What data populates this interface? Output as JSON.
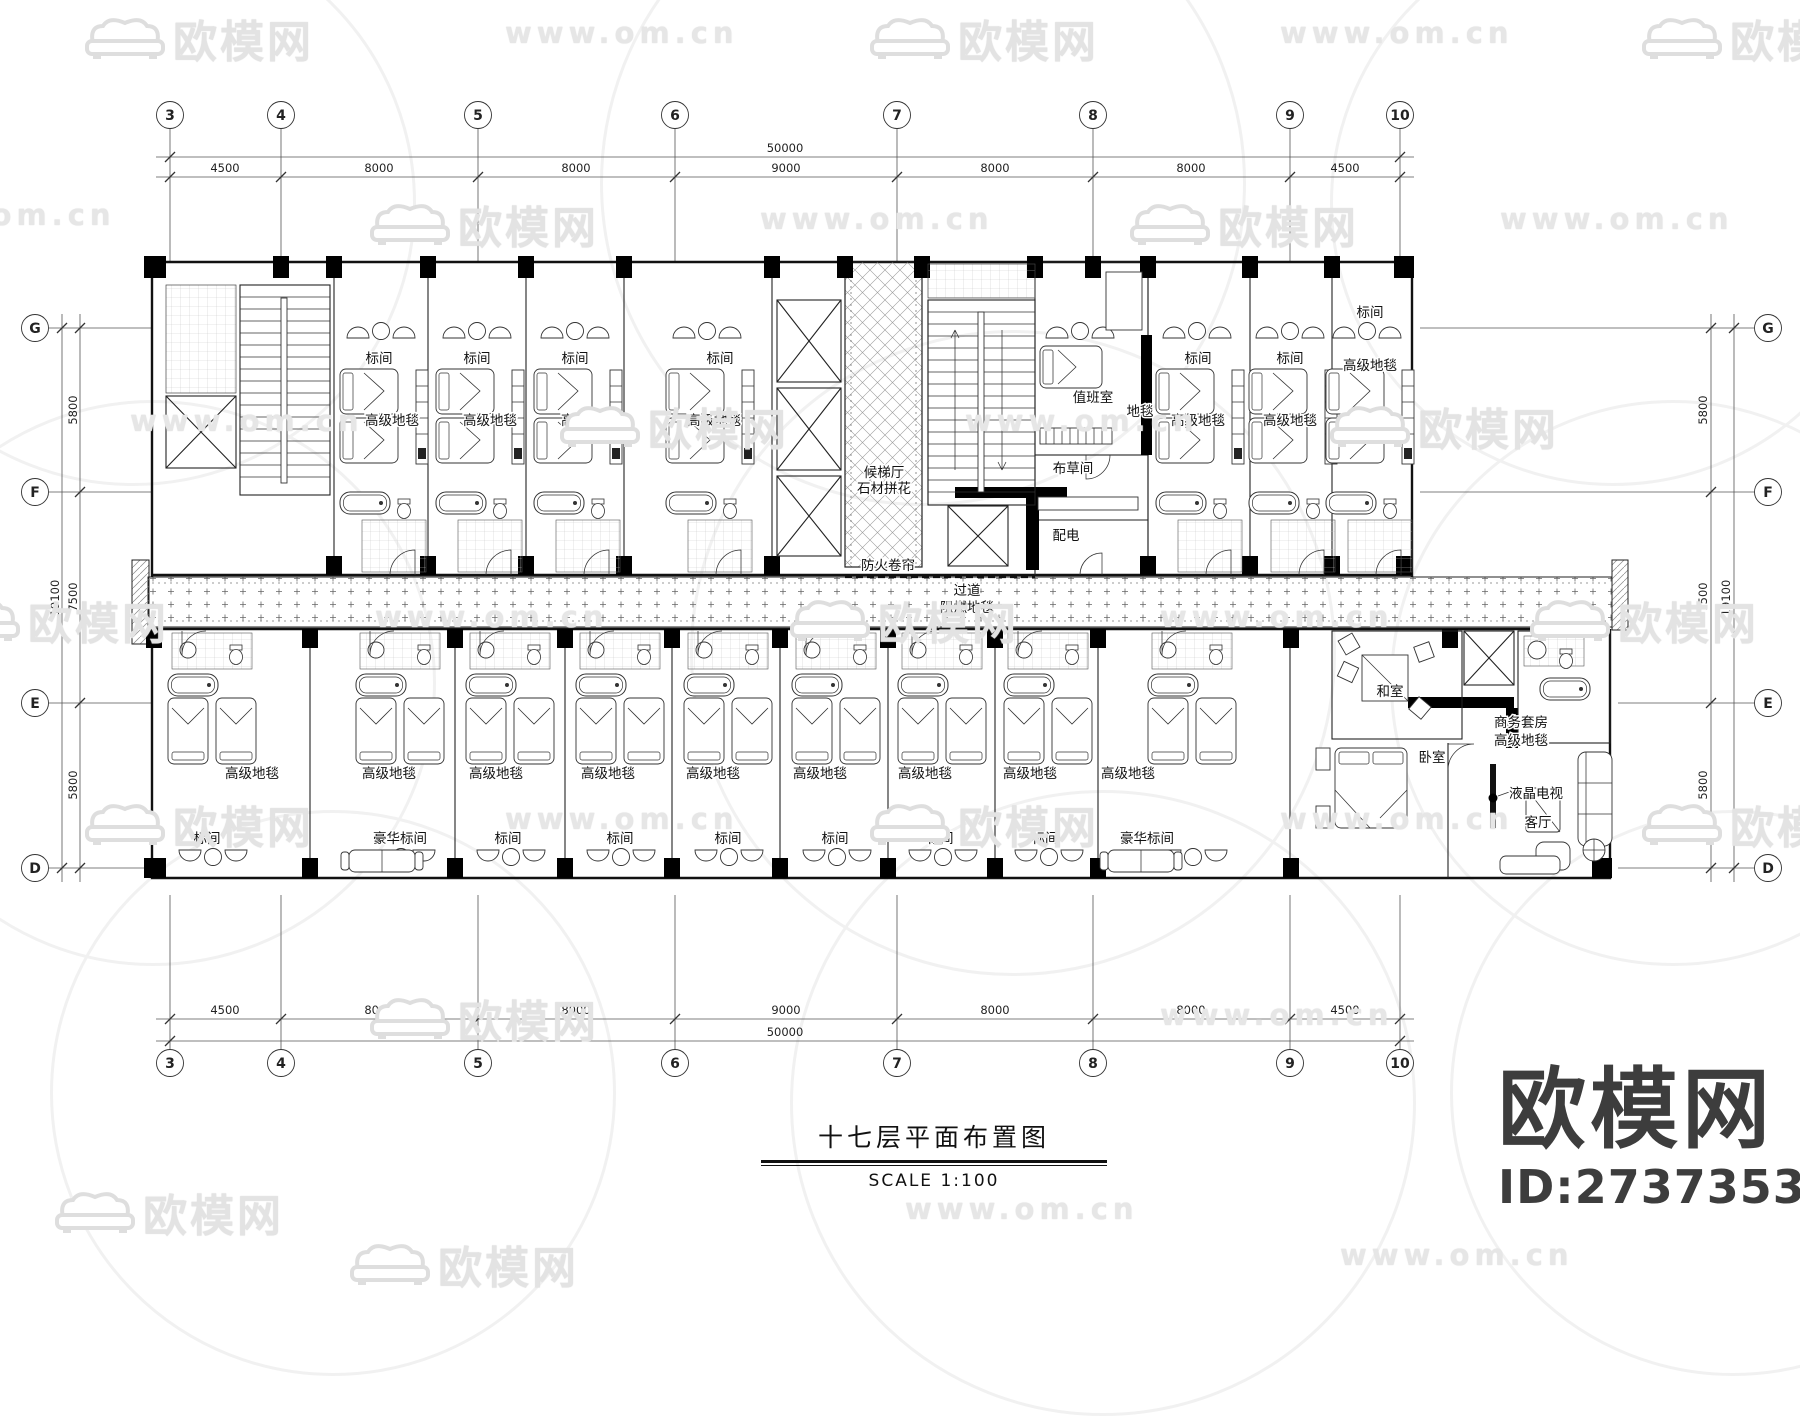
{
  "watermark": {
    "brand": "欧模网",
    "url": "www.om.cn",
    "url_short": "om.cn"
  },
  "logo": {
    "name": "欧模网",
    "id": "ID:2737353"
  },
  "title_block": {
    "title": "十七层平面布置图",
    "scale": "SCALE 1:100"
  },
  "grid": {
    "cols": [
      "3",
      "4",
      "5",
      "6",
      "7",
      "8",
      "9",
      "10"
    ],
    "rows": [
      "G",
      "F",
      "E",
      "D"
    ],
    "col_dims": [
      "4500",
      "8000",
      "8000",
      "9000",
      "8000",
      "8000",
      "4500"
    ],
    "col_total": "50000",
    "row_dims": [
      "5800",
      "7500",
      "5800"
    ],
    "row_total": "19100"
  },
  "rooms": {
    "standard": "标间",
    "deluxe": "豪华标间",
    "carpet": "高级地毯"
  },
  "core": {
    "lobby_line1": "候梯厅",
    "lobby_line2": "石材拼花",
    "duty": "值班室",
    "duty_carpet": "地毯",
    "linen": "布草间",
    "power": "配电",
    "fire_shutter": "防火卷帘",
    "corridor_line1": "过道",
    "corridor_line2": "阻燃地毯"
  },
  "suite": {
    "tatami": "和室",
    "name_line1": "商务套房",
    "name_line2": "高级地毯",
    "bedroom": "卧室",
    "tv": "液晶电视",
    "living": "客厅"
  }
}
